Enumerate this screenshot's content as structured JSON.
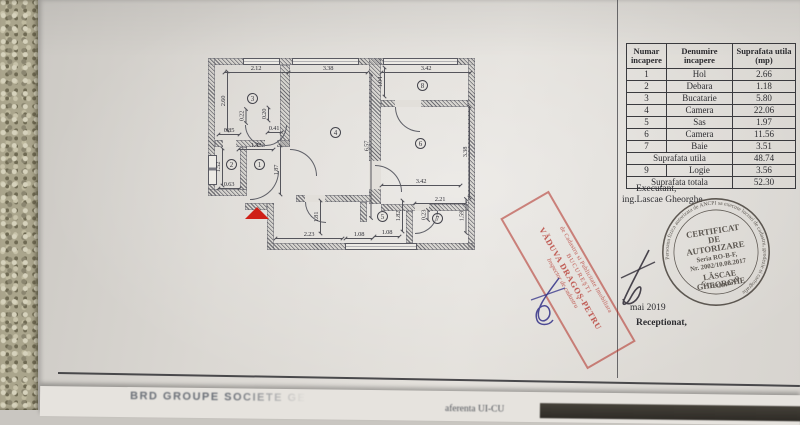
{
  "page": {
    "date": "mai 2019",
    "receptionat_label": "Receptionat,"
  },
  "area_table": {
    "headers": [
      "Numar\nincapere",
      "Denumire\nincapere",
      "Suprafata utila\n(mp)"
    ],
    "rows": [
      [
        "1",
        "Hol",
        "2.66"
      ],
      [
        "2",
        "Debara",
        "1.18"
      ],
      [
        "3",
        "Bucatarie",
        "5.80"
      ],
      [
        "4",
        "Camera",
        "22.06"
      ],
      [
        "5",
        "Sas",
        "1.97"
      ],
      [
        "6",
        "Camera",
        "11.56"
      ],
      [
        "7",
        "Baie",
        "3.51"
      ]
    ],
    "subtotal": {
      "label": "Suprafata utila",
      "value": "48.74"
    },
    "extra_row": [
      "9",
      "Logie",
      "3.56"
    ],
    "total": {
      "label": "Suprafata totala",
      "value": "52.30"
    }
  },
  "executant": {
    "line1": "Executant,",
    "line2": "ing.Lascae Gheorghe"
  },
  "round_stamp": {
    "ring_text": "Persoana fizica autorizata de ANCPI sa execute lucrari de cadastru, geodezie si cartografie",
    "category": "CATEGORIA D",
    "line1": "CERTIFICAT",
    "line2": "DE",
    "line3": "AUTORIZARE",
    "line4": "Seria RO-B-F,",
    "line5": "Nr. 2002/10.08.2017",
    "line6": "LĂSCAE",
    "line7": "GHEORGHE"
  },
  "red_stamp": {
    "line1": "de Cadastru si Publicitate Imobiliara",
    "line2": "BUCUREŞTI",
    "line3": "VĂDUVA DRAGOŞ-PETRU",
    "line4": "Inspector de cadastru"
  },
  "underlying": {
    "text1": "BRD GROUPE SOCIETE GEN",
    "text2": "aferenta UI-CU"
  },
  "colors": {
    "stamp_red": "#b5342c",
    "ink_blue": "#3b3a8c",
    "triangle_red": "#cf1f16",
    "stamp_black": "#46403a"
  },
  "floorplan": {
    "rooms": [
      {
        "n": "3",
        "x": 50,
        "y": 46
      },
      {
        "n": "4",
        "x": 133,
        "y": 80
      },
      {
        "n": "8",
        "x": 220,
        "y": 33
      },
      {
        "n": "6",
        "x": 218,
        "y": 91
      },
      {
        "n": "2",
        "x": 29,
        "y": 112
      },
      {
        "n": "1",
        "x": 57,
        "y": 112
      },
      {
        "n": "5",
        "x": 180,
        "y": 164
      },
      {
        "n": "7",
        "x": 235,
        "y": 166
      }
    ],
    "dims": [
      {
        "t": "2.12",
        "x": 53,
        "y": 20,
        "v": 0,
        "len": 65
      },
      {
        "t": "3.38",
        "x": 125,
        "y": 20,
        "v": 0,
        "len": 80
      },
      {
        "t": "3.42",
        "x": 223,
        "y": 20,
        "v": 0,
        "len": 90
      },
      {
        "t": "2.60",
        "x": 21,
        "y": 52,
        "v": 1,
        "len": 60
      },
      {
        "t": "1.04",
        "x": 178,
        "y": 33,
        "v": 1,
        "len": 30
      },
      {
        "t": "0.22",
        "x": 39,
        "y": 67,
        "v": 1,
        "len": 15
      },
      {
        "t": "0.20",
        "x": 62,
        "y": 65,
        "v": 1,
        "len": 14
      },
      {
        "t": "0.85",
        "x": 26,
        "y": 82,
        "v": 0,
        "len": 22
      },
      {
        "t": "0.41",
        "x": 71,
        "y": 80,
        "v": 0,
        "len": 15
      },
      {
        "t": "1.42",
        "x": 53,
        "y": 97,
        "v": 0,
        "len": 36
      },
      {
        "t": "1.52",
        "x": 16,
        "y": 118,
        "v": 1,
        "len": 38
      },
      {
        "t": "1.87",
        "x": 74,
        "y": 121,
        "v": 1,
        "len": 50
      },
      {
        "t": "0.63",
        "x": 26,
        "y": 136,
        "v": 0,
        "len": 22
      },
      {
        "t": "6.57",
        "x": 164,
        "y": 97,
        "v": 1,
        "len": 145
      },
      {
        "t": "3.38",
        "x": 263,
        "y": 103,
        "v": 1,
        "len": 92
      },
      {
        "t": "3.42",
        "x": 218,
        "y": 133,
        "v": 0,
        "len": 80
      },
      {
        "t": "2.21",
        "x": 237,
        "y": 151,
        "v": 0,
        "len": 52
      },
      {
        "t": "1.81",
        "x": 114,
        "y": 168,
        "v": 1,
        "len": 34
      },
      {
        "t": "1.82",
        "x": 196,
        "y": 167,
        "v": 1,
        "len": 32
      },
      {
        "t": "0.23",
        "x": 221,
        "y": 166,
        "v": 1,
        "len": 11
      },
      {
        "t": "1.59",
        "x": 259,
        "y": 167,
        "v": 1,
        "len": 35
      },
      {
        "t": "2.23",
        "x": 106,
        "y": 186,
        "v": 0,
        "len": 68
      },
      {
        "t": "1.08",
        "x": 156,
        "y": 186,
        "v": 0,
        "len": 28
      },
      {
        "t": "1.08",
        "x": 184,
        "y": 184,
        "v": 0,
        "len": 26
      }
    ]
  }
}
